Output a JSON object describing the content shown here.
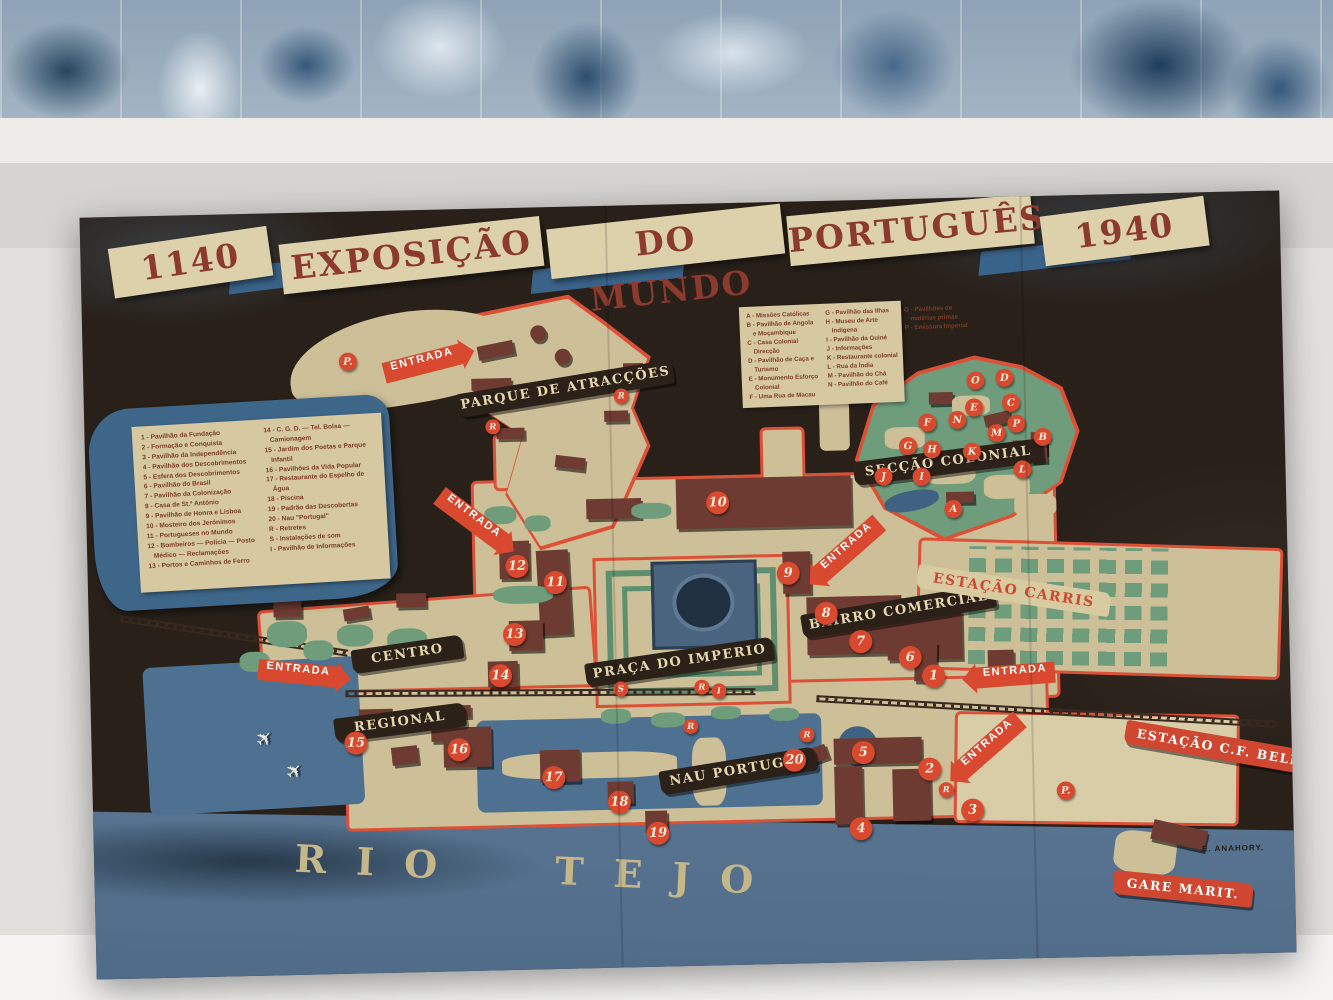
{
  "poster": {
    "title": {
      "segments": [
        "1140",
        "EXPOSIÇÃO",
        "DO MUNDO",
        "PORTUGUÊS",
        "1940"
      ]
    },
    "legend_numbered": [
      "1 - Pavilhão da Fundação",
      "2 - Formação e Conquista",
      "3 - Pavilhão da Independência",
      "4 - Pavilhão dos Descobrimentos",
      "5 - Esfera dos Descobrimentos",
      "6 - Pavilhão do Brasil",
      "7 - Pavilhão da Colonização",
      "8 - Casa de St.º António",
      "9 - Pavilhão de Honra e Lisboa",
      "10 - Mosteiro dos Jerónimos",
      "11 - Portugueses no Mundo",
      "12 - Bombeiros — Polícia — Posto Médico — Reclamações",
      "13 - Portos e Caminhos de Ferro",
      "14 - C. G. D. — Tel. Bolsa — Camionagem",
      "15 - Jardim dos Poetas e Parque Infantil",
      "16 - Pavilhões da Vida Popular",
      "17 - Restaurante do Espelho de Água",
      "18 - Piscina",
      "19 - Padrão das Descobertas",
      "20 - Nau \"Portugal\"",
      "R - Retretes",
      "S - Instalações de som",
      "I - Pavilhão de Informações"
    ],
    "legend_lettered": [
      "A - Missões Católicas",
      "B - Pavilhão de Angola e Moçambique",
      "C - Casa Colonial Direcção",
      "D - Pavilhão de Caça e Turismo",
      "E - Monumento Esforço Colonial",
      "F - Uma Rua de Macau",
      "G - Pavilhão das Ilhas",
      "H - Museu de Arte Indígena",
      "I - Pavilhão da Guiné",
      "J - Informações",
      "K - Restaurante colonial",
      "L - Rua da Índia",
      "M - Pavilhão do Chá",
      "N - Pavilhão do Café",
      "O - Pavilhões de matérias primas",
      "P - Emissora Imperial"
    ],
    "labels": [
      {
        "t": "PARQUE DE ATRACÇÕES",
        "x": 373,
        "y": 170,
        "w": 218,
        "rot": -8,
        "k": "dark"
      },
      {
        "t": "SECÇÃO COLONIAL",
        "x": 768,
        "y": 252,
        "w": 190,
        "rot": -6,
        "k": "dark"
      },
      {
        "t": "BAIRRO COMERCIAL",
        "x": 712,
        "y": 400,
        "w": 196,
        "rot": -8,
        "k": "dark"
      },
      {
        "t": "PRAÇA DO IMPERIO",
        "x": 495,
        "y": 446,
        "w": 190,
        "rot": -7,
        "k": "dark"
      },
      {
        "t": "CENTRO",
        "x": 262,
        "y": 432,
        "w": 112,
        "rot": -7,
        "k": "dark"
      },
      {
        "t": "REGIONAL",
        "x": 243,
        "y": 500,
        "w": 132,
        "rot": -6,
        "k": "dark"
      },
      {
        "t": "NAU PORTUGAL",
        "x": 567,
        "y": 556,
        "w": 158,
        "rot": -8,
        "k": "dark"
      },
      {
        "t": "ESTAÇÃO CARRIS",
        "x": 828,
        "y": 382,
        "w": 195,
        "rot": 10,
        "k": "cream"
      },
      {
        "t": "ESTAÇÃO C.F. BELEM",
        "x": 1032,
        "y": 545,
        "w": 205,
        "rot": 11,
        "k": "red"
      },
      {
        "t": "GARE MARIT.",
        "x": 1018,
        "y": 684,
        "w": 140,
        "rot": 7,
        "k": "red"
      }
    ],
    "entrances": [
      {
        "t": "ENTRADA",
        "x": 300,
        "y": 143,
        "rot": -13,
        "k": "r"
      },
      {
        "t": "ENTRADA",
        "x": 345,
        "y": 300,
        "rot": 38,
        "k": "r"
      },
      {
        "t": "ENTRADA",
        "x": 168,
        "y": 450,
        "rot": 7,
        "k": "r"
      },
      {
        "t": "ENTRADA",
        "x": 722,
        "y": 338,
        "rot": -40,
        "k": "l"
      },
      {
        "t": "ENTRADA",
        "x": 885,
        "y": 468,
        "rot": -3,
        "k": "l"
      },
      {
        "t": "ENTRADA",
        "x": 858,
        "y": 538,
        "rot": -40,
        "k": "l"
      }
    ],
    "markers": [
      {
        "t": "1",
        "x": 832,
        "y": 466,
        "k": "n"
      },
      {
        "t": "2",
        "x": 826,
        "y": 559,
        "k": "n"
      },
      {
        "t": "3",
        "x": 868,
        "y": 601,
        "k": "n"
      },
      {
        "t": "4",
        "x": 756,
        "y": 617,
        "k": "n"
      },
      {
        "t": "5",
        "x": 760,
        "y": 541,
        "k": "n"
      },
      {
        "t": "6",
        "x": 809,
        "y": 447,
        "k": "n"
      },
      {
        "t": "7",
        "x": 760,
        "y": 430,
        "k": "n"
      },
      {
        "t": "8",
        "x": 726,
        "y": 401,
        "k": "n"
      },
      {
        "t": "9",
        "x": 689,
        "y": 360,
        "k": "n"
      },
      {
        "t": "10",
        "x": 620,
        "y": 288,
        "k": "n"
      },
      {
        "t": "11",
        "x": 456,
        "y": 364,
        "k": "n"
      },
      {
        "t": "12",
        "x": 418,
        "y": 347,
        "k": "n"
      },
      {
        "t": "13",
        "x": 414,
        "y": 415,
        "k": "n"
      },
      {
        "t": "14",
        "x": 399,
        "y": 456,
        "k": "n"
      },
      {
        "t": "15",
        "x": 253,
        "y": 520,
        "k": "n"
      },
      {
        "t": "16",
        "x": 356,
        "y": 529,
        "k": "n"
      },
      {
        "t": "17",
        "x": 450,
        "y": 559,
        "k": "n"
      },
      {
        "t": "18",
        "x": 515,
        "y": 585,
        "k": "n"
      },
      {
        "t": "19",
        "x": 553,
        "y": 617,
        "k": "n"
      },
      {
        "t": "20",
        "x": 691,
        "y": 547,
        "k": "n"
      },
      {
        "t": "A",
        "x": 858,
        "y": 302,
        "k": "l"
      },
      {
        "t": "B",
        "x": 949,
        "y": 232,
        "k": "l"
      },
      {
        "t": "C",
        "x": 918,
        "y": 197,
        "k": "l"
      },
      {
        "t": "D",
        "x": 912,
        "y": 172,
        "k": "l"
      },
      {
        "t": "E",
        "x": 881,
        "y": 201,
        "k": "l"
      },
      {
        "t": "F",
        "x": 834,
        "y": 215,
        "k": "l"
      },
      {
        "t": "G",
        "x": 814,
        "y": 238,
        "k": "l"
      },
      {
        "t": "H",
        "x": 838,
        "y": 242,
        "k": "l"
      },
      {
        "t": "I",
        "x": 827,
        "y": 269,
        "k": "l"
      },
      {
        "t": "J",
        "x": 789,
        "y": 268,
        "k": "l"
      },
      {
        "t": "K",
        "x": 878,
        "y": 245,
        "k": "l"
      },
      {
        "t": "L",
        "x": 928,
        "y": 264,
        "k": "l"
      },
      {
        "t": "M",
        "x": 903,
        "y": 227,
        "k": "l"
      },
      {
        "t": "N",
        "x": 864,
        "y": 213,
        "k": "l"
      },
      {
        "t": "O",
        "x": 883,
        "y": 174,
        "k": "l"
      },
      {
        "t": "P",
        "x": 923,
        "y": 218,
        "k": "l"
      },
      {
        "t": "P.",
        "x": 256,
        "y": 141,
        "k": "p"
      },
      {
        "t": "P.",
        "x": 964,
        "y": 586,
        "k": "p"
      },
      {
        "t": "R",
        "x": 401,
        "y": 211,
        "k": "s"
      },
      {
        "t": "R",
        "x": 530,
        "y": 183,
        "k": "s"
      },
      {
        "t": "S",
        "x": 523,
        "y": 476,
        "k": "s"
      },
      {
        "t": "R",
        "x": 604,
        "y": 476,
        "k": "s"
      },
      {
        "t": "I",
        "x": 621,
        "y": 480,
        "k": "s"
      },
      {
        "t": "R",
        "x": 592,
        "y": 515,
        "k": "s"
      },
      {
        "t": "R",
        "x": 708,
        "y": 526,
        "k": "s"
      },
      {
        "t": "R",
        "x": 846,
        "y": 584,
        "k": "s"
      }
    ],
    "river_label": "RIO TEJO",
    "signature": "E. ANAHORY.",
    "colors": {
      "accent_red": "#d8492f",
      "ground_tan": "#cdbf98",
      "ribbon_dark": "#2b2119",
      "water_blue": "#4e7191",
      "garden_green": "#6f9d7c",
      "title_red": "#8c3a2e",
      "legend_blue": "#3e6689"
    }
  }
}
